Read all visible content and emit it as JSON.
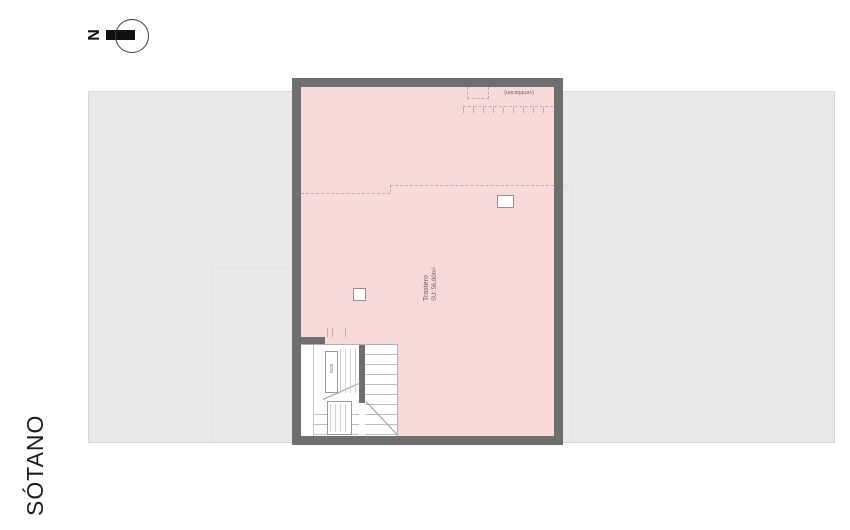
{
  "page": {
    "title_label": "SÓTANO"
  },
  "north_arrow": {
    "label": "N"
  },
  "plan": {
    "room": {
      "name": "Trastero",
      "area": "SU: 56.80m²"
    },
    "skylight_label": "(ventilación)",
    "stair": {
      "acs_label": "ACS"
    }
  },
  "colors": {
    "wall": "#6e6e6e",
    "room": "#f9d8d8",
    "plot": "#e9e9e9",
    "plot_border": "#d6d6d6",
    "dash_pink": "#c5abab",
    "dash_gray": "#dcdcdc",
    "stair_line": "#bdbdbd",
    "ink": "#1c1c1c",
    "muted": "#6f6161"
  }
}
